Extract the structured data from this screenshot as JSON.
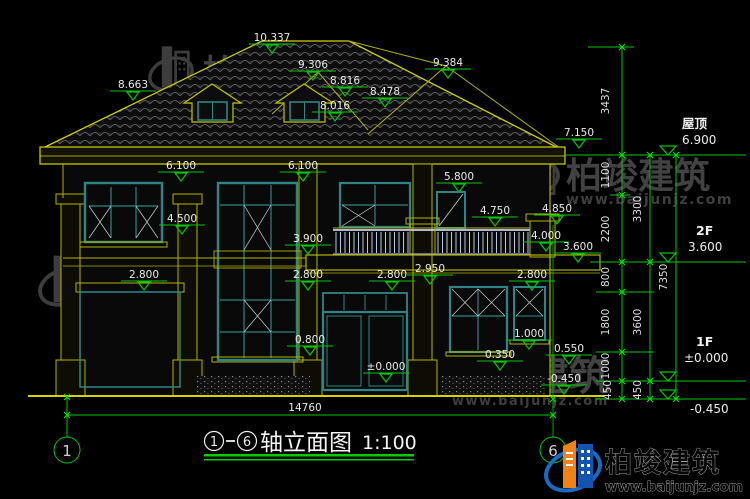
{
  "watermark": {
    "brand": "柏竣建筑",
    "url": "www.baijunjz.com"
  },
  "logo": {
    "brand": "柏竣建筑",
    "url": "www.baijunjz.com"
  },
  "title_block": {
    "axis_start": "1",
    "separator": "—",
    "axis_end": "6",
    "name": "轴立面图",
    "scale": "1:100"
  },
  "bottom_dim": "14760",
  "drawing": {
    "spot_elevations": [
      {
        "v": "10.337",
        "x": 272,
        "y": 41
      },
      {
        "v": "9.306",
        "x": 313,
        "y": 68
      },
      {
        "v": "8.816",
        "x": 345,
        "y": 84
      },
      {
        "v": "8.478",
        "x": 385,
        "y": 95
      },
      {
        "v": "8.663",
        "x": 133,
        "y": 88
      },
      {
        "v": "8.016",
        "x": 335,
        "y": 109
      },
      {
        "v": "9.384",
        "x": 448,
        "y": 66
      },
      {
        "v": "7.150",
        "x": 579,
        "y": 136
      },
      {
        "v": "6.100",
        "x": 181,
        "y": 169
      },
      {
        "v": "6.100",
        "x": 303,
        "y": 169
      },
      {
        "v": "5.800",
        "x": 459,
        "y": 180
      },
      {
        "v": "4.850",
        "x": 557,
        "y": 212
      },
      {
        "v": "4.750",
        "x": 495,
        "y": 214
      },
      {
        "v": "4.500",
        "x": 182,
        "y": 222
      },
      {
        "v": "4.000",
        "x": 546,
        "y": 239
      },
      {
        "v": "3.900",
        "x": 308,
        "y": 242
      },
      {
        "v": "3.600",
        "x": 578,
        "y": 250
      },
      {
        "v": "2.950",
        "x": 430,
        "y": 272
      },
      {
        "v": "2.800",
        "x": 144,
        "y": 278
      },
      {
        "v": "2.800",
        "x": 308,
        "y": 278
      },
      {
        "v": "2.800",
        "x": 392,
        "y": 278
      },
      {
        "v": "2.800",
        "x": 532,
        "y": 278
      },
      {
        "v": "1.000",
        "x": 529,
        "y": 337
      },
      {
        "v": "0.800",
        "x": 310,
        "y": 343
      },
      {
        "v": "0.550",
        "x": 569,
        "y": 352
      },
      {
        "v": "0.350",
        "x": 500,
        "y": 358
      },
      {
        "v": "±0.000",
        "x": 386,
        "y": 370
      },
      {
        "v": "-0.450",
        "x": 564,
        "y": 382
      }
    ],
    "levels": [
      {
        "name": "屋顶",
        "value": "6.900",
        "ly": 155,
        "x1": 565,
        "x2": 746,
        "tx": 668,
        "nx": 682,
        "ny": 128,
        "vx": 682,
        "vy": 144,
        "below": false
      },
      {
        "name": "2F",
        "value": "3.600",
        "ly": 262,
        "x1": 590,
        "x2": 746,
        "tx": 668,
        "nx": 696,
        "ny": 235,
        "vx": 688,
        "vy": 251,
        "below": false
      },
      {
        "name": "1F",
        "value": "±0.000",
        "ly": 381,
        "x1": 596,
        "x2": 746,
        "tx": 668,
        "nx": 696,
        "ny": 346,
        "vx": 684,
        "vy": 362,
        "below": false
      },
      {
        "name": "",
        "value": "-0.450",
        "ly": 399,
        "x1": 596,
        "x2": 746,
        "tx": 668,
        "nx": 0,
        "ny": 0,
        "vx": 690,
        "vy": 413,
        "below": true
      }
    ],
    "vertical_dims": [
      {
        "v": "3437",
        "x": 609,
        "y": 101
      },
      {
        "v": "1100",
        "x": 609,
        "y": 175
      },
      {
        "v": "2200",
        "x": 609,
        "y": 229
      },
      {
        "v": "800",
        "x": 609,
        "y": 277
      },
      {
        "v": "1800",
        "x": 609,
        "y": 322
      },
      {
        "v": "1000",
        "x": 609,
        "y": 366
      },
      {
        "v": "450",
        "x": 611,
        "y": 390
      },
      {
        "v": "3300",
        "x": 641,
        "y": 209
      },
      {
        "v": "3600",
        "x": 641,
        "y": 322
      },
      {
        "v": "450",
        "x": 641,
        "y": 390
      },
      {
        "v": "7350",
        "x": 667,
        "y": 277
      }
    ],
    "axis_bubbles": [
      {
        "label": "1",
        "x": 67,
        "y": 450
      },
      {
        "label": "6",
        "x": 553,
        "y": 450
      }
    ],
    "ticks": [
      [
        622,
        47
      ],
      [
        622,
        155
      ],
      [
        622,
        195
      ],
      [
        622,
        262
      ],
      [
        622,
        292
      ],
      [
        622,
        352
      ],
      [
        622,
        381
      ],
      [
        622,
        399
      ],
      [
        650,
        155
      ],
      [
        650,
        262
      ],
      [
        650,
        381
      ],
      [
        650,
        399
      ],
      [
        676,
        155
      ],
      [
        676,
        399
      ],
      [
        67,
        415
      ],
      [
        553,
        415
      ],
      [
        67,
        397
      ],
      [
        553,
        399
      ]
    ]
  }
}
